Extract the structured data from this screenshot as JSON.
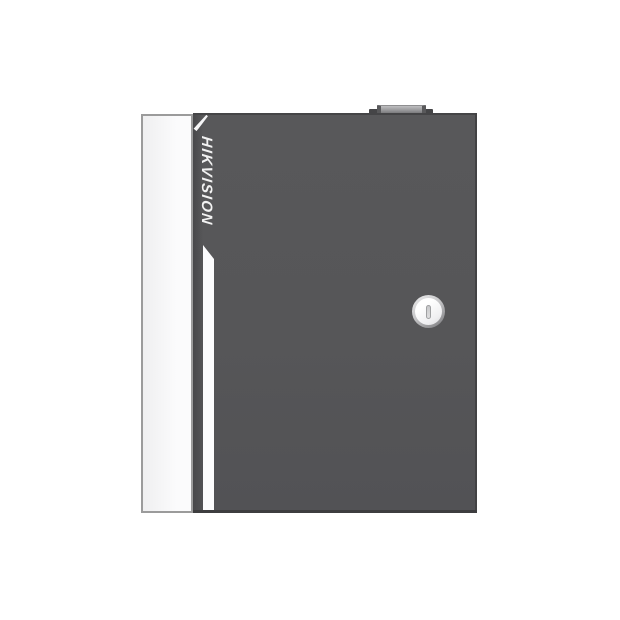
{
  "scene": {
    "background": "#ffffff"
  },
  "device": {
    "brand": "HIKVISION",
    "colors": {
      "background": "#ffffff",
      "body": "#565658",
      "body_edge": "#454547",
      "body_left_shade": "#48484a",
      "side_panel": "#fbfbfc",
      "side_panel_border": "#9b9b9b",
      "stripe": "#fcfcfd",
      "brand_text": "#f2f2f2",
      "knob_top": "#bfbfc1",
      "knob_side": "#59595b",
      "knob_base": "#454547",
      "lock_rim_light": "#ededee",
      "lock_rim_dark": "#77777a",
      "lock_face": "#ffffff",
      "lock_face_shade": "#dadadc",
      "keyhole_fill": "#dededf",
      "keyhole_border": "#9fa0a2"
    }
  }
}
